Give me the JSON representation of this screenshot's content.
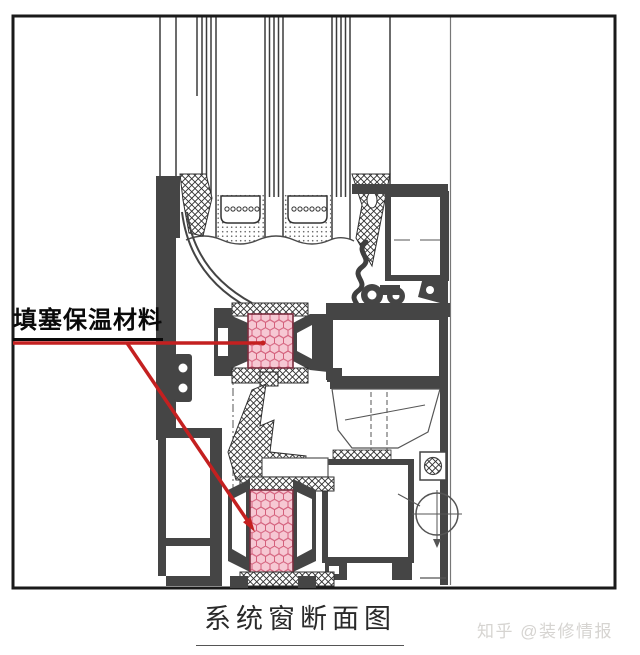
{
  "annotation": {
    "label": "填塞保温材料"
  },
  "caption": "系统窗断面图",
  "watermark": "知乎 @装修情报",
  "colors": {
    "annotation_red": "#c42020",
    "insulation_fill": "#f6c8d3",
    "insulation_line": "#d4607c",
    "insulation_border": "#7a2d3e",
    "profile_dark": "#454545",
    "line_dark": "#3c3c3c",
    "hatch_line": "#2f2f2f",
    "watermark_gray": "#d6d4d1",
    "background": "#ffffff",
    "border_black": "#1a1a1a"
  }
}
